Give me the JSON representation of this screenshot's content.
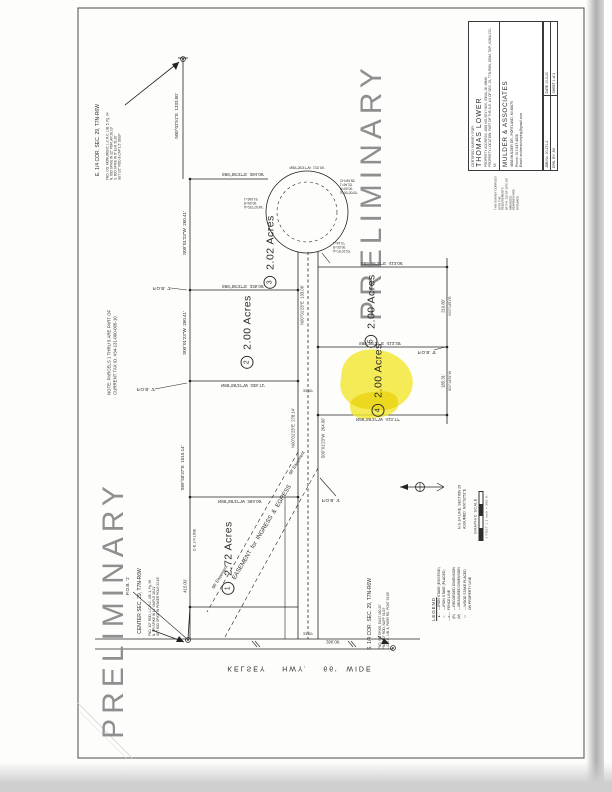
{
  "page": {
    "watermark": "PRELIMINARY",
    "road_label": "KELSEY    HWY.    66'  WIDE"
  },
  "title_block": {
    "certified_for": "CERTIFIED SURVEY FOR:",
    "client": "THOMAS LOWER",
    "address": "PROPERTY ADDRESS:  1861 KELSEY HWY., IONIA, MI 48846",
    "location": "PROPERTY LOCATION:  PART OF THE N.E. 1/4 OF SEC. 29, T7N-R6W, IONIA TWP., IONIA CO., MI",
    "firm_name": "MULDER & ASSOCIATES",
    "firm_address": "4868 MULDER DR., PORTLAND, MI 48875",
    "firm_phone": "Phone: 517-647-4828",
    "firm_email": "Email: muldersurveying@gmail.com",
    "job": "JOB No. 20-271-2",
    "date": "DATE  10-5-20",
    "drawn_by": "DRN. BY:  JM",
    "sheet": "SHEET 1 of 2"
  },
  "parcels": [
    {
      "number": "3",
      "acreage": "2.02 Acres",
      "x": 270,
      "y": 252
    },
    {
      "number": "2",
      "acreage": "2.00 Acres",
      "x": 247,
      "y": 332
    },
    {
      "number": "1",
      "acreage": "2.72 Acres",
      "x": 228,
      "y": 558
    },
    {
      "number": "4",
      "acreage": "2.00 Acres",
      "x": 378,
      "y": 380,
      "highlighted": true
    },
    {
      "number": "5",
      "acreage": "2.00 Acres",
      "x": 371,
      "y": 311
    }
  ],
  "legend": {
    "header": "LEGEND",
    "items": [
      {
        "symbol": "●",
        "label": "—IRON STAKE (EXISTING)"
      },
      {
        "symbol": "○",
        "label": "—IRON STAKE (PLACED)"
      },
      {
        "symbol": "—x—",
        "label": "FENCE LINE"
      },
      {
        "symbol": "(R)",
        "label": "—RECORDED DIMENSION"
      },
      {
        "symbol": "(M)",
        "label": "—MEASURED DIMENSION"
      },
      {
        "symbol": "□",
        "label": "—WOOD STAKE PLACED\nON PROPERTY LINE"
      }
    ]
  },
  "graphic_scale": {
    "title": "GRAPHIC SCALE",
    "caption": "( FEET )  1 inch = 200 ft."
  },
  "annotations": [
    {
      "t": "N00°02'51\"E  1333.00'",
      "x": 177,
      "y": 116,
      "m": "r",
      "s": 4.5
    },
    {
      "t": "S89°58'37\"E  394.06'",
      "x": 243,
      "y": 174,
      "m": "f",
      "s": 4.5
    },
    {
      "t": "S00°01'23\"W  260.41'",
      "x": 185,
      "y": 233,
      "m": "r",
      "s": 4.5
    },
    {
      "t": "S89°58'37\"E  335.06'",
      "x": 243,
      "y": 286,
      "m": "f",
      "s": 4.5
    },
    {
      "t": "N89°58'37\"W  335.71'",
      "x": 243,
      "y": 385,
      "m": "f",
      "s": 4.5
    },
    {
      "t": "S00°01'23\"W  260.41'",
      "x": 185,
      "y": 333,
      "m": "r",
      "s": 4.5
    },
    {
      "t": "S89°58'37\"E  1015.14'",
      "x": 183,
      "y": 468,
      "m": "r",
      "s": 4.5
    },
    {
      "t": "C-E 1/4 LINE",
      "x": 195,
      "y": 540,
      "m": "r",
      "s": 3.8
    },
    {
      "t": "415.00'",
      "x": 185,
      "y": 586,
      "m": "r",
      "s": 4.2
    },
    {
      "t": "N89°58'37\"W  394.06'",
      "x": 240,
      "y": 501,
      "m": "f",
      "s": 4.5
    },
    {
      "t": "N00°01'23\"E  278.14'",
      "x": 293,
      "y": 428,
      "m": "r",
      "s": 4.2
    },
    {
      "t": "S00°01'23\"W  264.00'",
      "x": 323,
      "y": 438,
      "m": "r",
      "s": 4.2
    },
    {
      "t": "N00°01'23\"E  133.06'",
      "x": 302,
      "y": 305,
      "m": "r",
      "s": 4.2
    },
    {
      "t": "33.00'",
      "x": 308,
      "y": 390,
      "m": "f",
      "s": 3.8
    },
    {
      "t": "33.00'",
      "x": 308,
      "y": 633,
      "m": "f",
      "s": 3.8
    },
    {
      "t": "S89°58'37\"E  413.06'",
      "x": 382,
      "y": 263,
      "m": "f",
      "s": 4.5
    },
    {
      "t": "S89°58'37\"E  413.29'",
      "x": 380,
      "y": 343,
      "m": "f",
      "s": 4.5
    },
    {
      "t": "N89°58'37\"W  413.77'",
      "x": 378,
      "y": 419,
      "m": "f",
      "s": 4.5
    },
    {
      "t": "210.80'",
      "x": 443,
      "y": 306,
      "m": "r",
      "s": 4.2
    },
    {
      "t": "N00°14'51\"E",
      "x": 450,
      "y": 306,
      "m": "r",
      "s": 3.4
    },
    {
      "t": "185.31'",
      "x": 443,
      "y": 381,
      "m": "r",
      "s": 4.2
    },
    {
      "t": "S00°14'51\"W",
      "x": 450,
      "y": 381,
      "m": "r",
      "s": 3.4
    },
    {
      "t": "P.O.B. '3'",
      "x": 162,
      "y": 288,
      "m": "f",
      "s": 4.6
    },
    {
      "t": "P.O.B. '2'",
      "x": 146,
      "y": 389,
      "m": "f",
      "s": 4.6
    },
    {
      "t": "P.O.B. '4'",
      "x": 331,
      "y": 500,
      "m": "f",
      "s": 4.6
    },
    {
      "t": "P.O.B. '5'",
      "x": 427,
      "y": 352,
      "m": "f",
      "s": 4.6
    },
    {
      "t": "P.O.B. '1'",
      "x": 128,
      "y": 586,
      "m": "r",
      "s": 4.6
    },
    {
      "t": "Δ=90°00'00\"\nR=60.00'\nL=94.25'\nCH=84.85'",
      "x": 353,
      "y": 186,
      "m": "f",
      "s": 3.2,
      "w": 26
    },
    {
      "t": "Δ=257°02'46\"\nR=60.00'\nL=269.19'",
      "x": 257,
      "y": 203,
      "m": "f",
      "s": 3.2,
      "w": 26
    },
    {
      "t": "Δ=76°31'23\"\nR=33.00'\nL=44.07'",
      "x": 345,
      "y": 247,
      "m": "f",
      "s": 3.2,
      "w": 24
    },
    {
      "t": "N89°58'37\"W  120.06'",
      "x": 307,
      "y": 167,
      "m": "f",
      "s": 3.6
    },
    {
      "t": "EASEMENT  for  INGRESS  &  EGRESS",
      "x": 263,
      "y": 533,
      "m": "d",
      "s": 6
    },
    {
      "t": "66' Easement",
      "x": 220,
      "y": 577,
      "m": "d",
      "s": 4.4
    },
    {
      "t": "66' Easement",
      "x": 297,
      "y": 463,
      "m": "d",
      "s": 4.4
    },
    {
      "t": "266.06'",
      "x": 333,
      "y": 642,
      "m": "f",
      "s": 4.2
    },
    {
      "t": "NOTE: PARCELS 1 THRU 5 ARE PART OF\nCURRENT TAX ID. #34-131-000-005-10",
      "x": 112,
      "y": 345,
      "m": "r",
      "s": 4.4,
      "w": 100
    },
    {
      "t": "E. 1/4 COR. SEC. 29, T7N-R6W",
      "x": 98,
      "y": 140,
      "m": "r",
      "s": 5
    },
    {
      "t": "FND. CO. MONUMENT, L.C.R.C. LIB. 5, Pg. 94\nN. 60D SPIKE IN 12\" POPLAR  26.13'\nS. 60D SPIKE IN 8\" ELM  31.20'\nSET 1/2\" ROD & CAP  1.5' DEEP",
      "x": 114,
      "y": 140,
      "m": "r",
      "s": 3.2,
      "w": 80
    },
    {
      "t": "CENTER SEC. 29, T7N-R6W",
      "x": 140,
      "y": 601,
      "m": "r",
      "s": 5
    },
    {
      "t": "FND. 1/2\" ROD, L.C.R.C. LIB. 1, Pg. 98\nN. RR SPIKE IN 14\" MAPLE  18.21'\nSET 60D SPIKE IN POWER POLE  22.16'",
      "x": 154,
      "y": 601,
      "m": "r",
      "s": 3.2,
      "w": 70
    },
    {
      "t": "S. 1/4 COR. SEC. 29, T7N-R6W",
      "x": 370,
      "y": 614,
      "m": "r",
      "s": 5
    },
    {
      "t": "FND. RR SPIKE, EAST  150.29'\nFND. 1/2\" ROD, NAFF  91.03'\nL.C.R.C. LIB. 8, PARR RD. POST  93.63'",
      "x": 384,
      "y": 614,
      "m": "r",
      "s": 3.2,
      "w": 70
    },
    {
      "t": "N-S 1/4 LINE, SECTION 29\nASSUMED:  N00°02'51\"E",
      "x": 462,
      "y": 500,
      "m": "r",
      "s": 3.6,
      "w": 58
    },
    {
      "t": "THIS SURVEY COMPLIES WITH THE REQUIREMENTS\nOF P.A. 132 OF 1970, AS AMENDED.\nBEARINGS ARE ASSUMED.",
      "x": 507,
      "y": 192,
      "m": "r",
      "s": 2.8,
      "w": 36
    },
    {
      "t": "KELSEY    HWY.    66'  WIDE",
      "x": 300,
      "y": 668,
      "m": "f",
      "s": 7,
      "ls": 2
    }
  ]
}
